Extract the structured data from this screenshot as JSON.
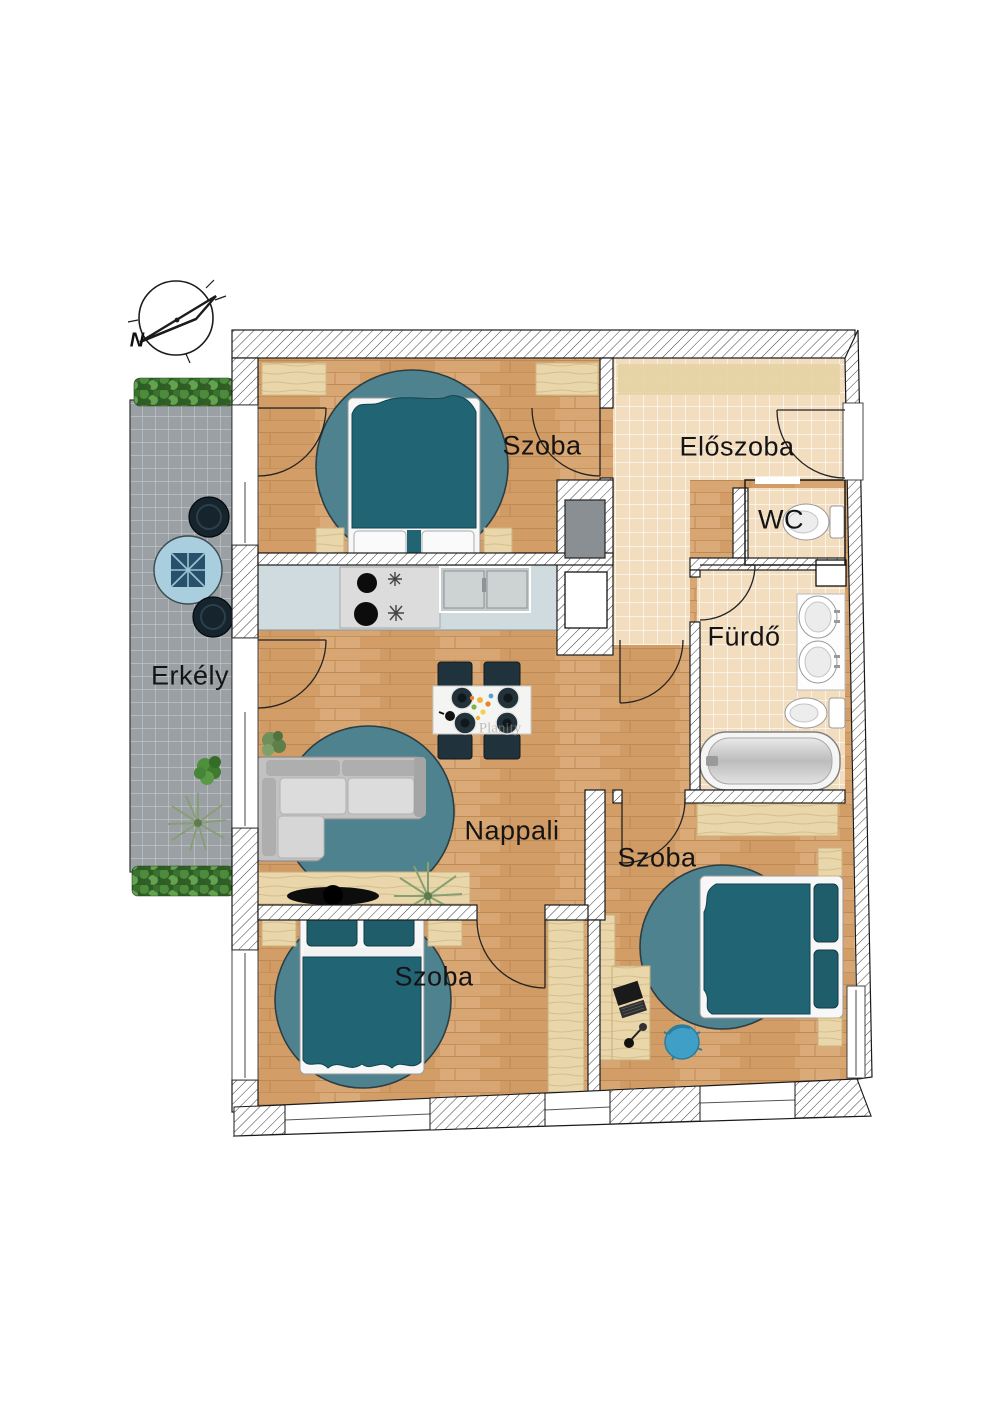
{
  "labels": {
    "room_szoba_top": "Szoba",
    "room_eloszoba": "Előszoba",
    "room_wc": "WC",
    "room_furdo": "Fürdő",
    "room_erkely": "Erkély",
    "room_nappali": "Nappali",
    "room_szoba_right": "Szoba",
    "room_szoba_bottom": "Szoba"
  },
  "compass": {
    "north_label": "N"
  },
  "watermark": {
    "text": "Planity"
  },
  "colors": {
    "wood_floor": "#d8a672",
    "tile_beige": "#f3ddbf",
    "tile_gray": "#9fa5a8",
    "teal_furniture": "#216474",
    "rug_teal": "#4f828f",
    "kitchen_counter": "#cfdbdf",
    "light_wood": "#e9d7ab",
    "wall_outline": "#1a1a1a"
  }
}
